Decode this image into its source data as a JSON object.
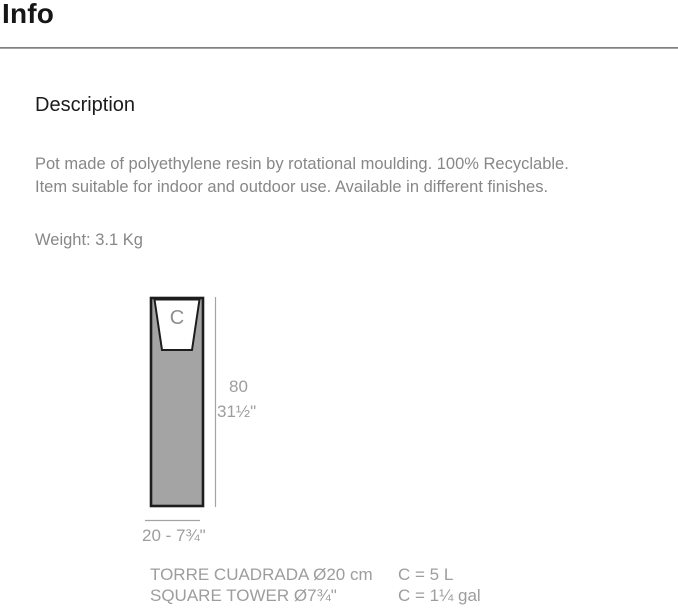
{
  "page": {
    "title": "Info"
  },
  "description": {
    "heading": "Description",
    "lines": [
      "Pot made of polyethylene resin by rotational moulding. 100% Recyclable.",
      "Item suitable for indoor and outdoor use. Available in different finishes."
    ],
    "weight": "Weight: 3.1 Kg"
  },
  "diagram": {
    "cavity_label": "C",
    "height_cm": "80",
    "height_in": "31½\"",
    "width_label": "20 - 7¾\"",
    "colors": {
      "body_fill": "#a4a4a4",
      "outline": "#1d1d1d",
      "dimension_line": "#a3a3a3",
      "label_text": "#9d9d9d"
    }
  },
  "products": [
    {
      "name": "TORRE CUADRADA Ø20 cm",
      "capacity": "C = 5 L"
    },
    {
      "name": "SQUARE TOWER Ø7¾\"",
      "capacity": "C = 1¼ gal"
    }
  ]
}
